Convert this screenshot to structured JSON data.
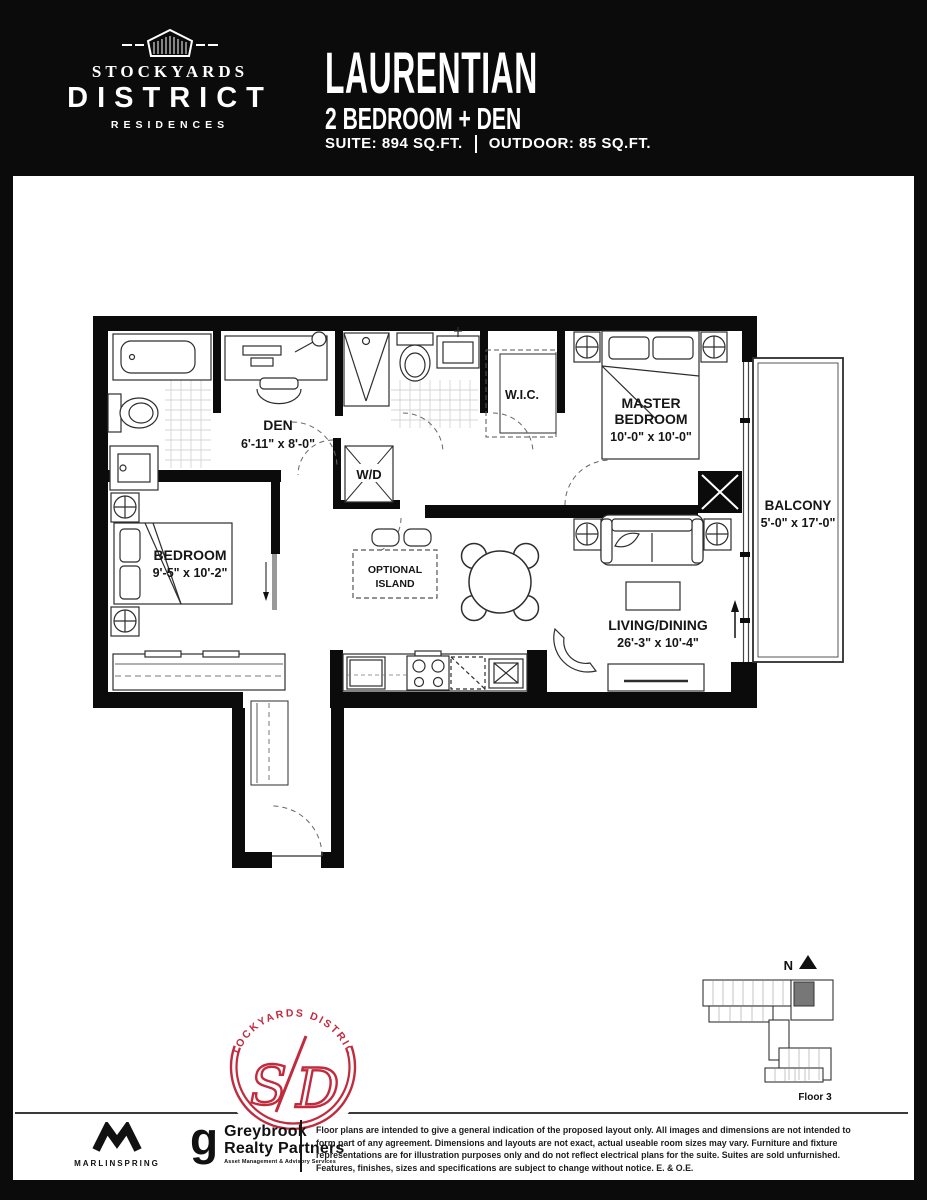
{
  "header": {
    "brand_line1": "STOCKYARDS",
    "brand_line2": "DISTRICT",
    "brand_line3": "RESIDENCES",
    "plan_name": "LAURENTIAN",
    "plan_type": "2 BEDROOM + DEN",
    "suite_label": "SUITE: 894 SQ.FT.",
    "outdoor_label": "OUTDOOR: 85 SQ.FT."
  },
  "floorplan": {
    "den_name": "DEN",
    "den_dims": "6'-11\" x 8'-0\"",
    "wic_name": "W.I.C.",
    "master_line1": "MASTER",
    "master_line2": "BEDROOM",
    "master_dims": "10'-0\" x 10'-0\"",
    "balcony_name": "BALCONY",
    "balcony_dims": "5'-0\" x 17'-0\"",
    "bedroom_name": "BEDROOM",
    "bedroom_dims": "9'-5\" x 10'-2\"",
    "living_name": "LIVING/DINING",
    "living_dims": "26'-3\" x 10'-4\"",
    "island_line1": "OPTIONAL",
    "island_line2": "ISLAND",
    "wd_label": "W/D"
  },
  "badge": {
    "arc_text": "STOCKYARDS  DISTRICT",
    "letter_s": "S",
    "letter_d": "D",
    "color": "#c22a3d"
  },
  "keyplan": {
    "north": "N",
    "floor": "Floor 3"
  },
  "footer": {
    "marlinspring": "MARLINSPRING",
    "greybrook_g": "g",
    "greybrook_line1": "Greybrook",
    "greybrook_line2": "Realty Partners",
    "greybrook_tagline": "Asset Management & Advisory Services",
    "disclaimer": [
      "Floor plans are intended to give a general indication of the proposed layout only. All images and dimensions are not intended to",
      "form part of any agreement. Dimensions and layouts are not exact, actual useable room sizes may vary. Furniture and fixture",
      "representations are for illustration purposes only and do not reflect electrical plans for the suite. Suites are sold unfurnished.",
      "Features, finishes, sizes and specifications are subject to change without notice. E. & O.E."
    ]
  }
}
